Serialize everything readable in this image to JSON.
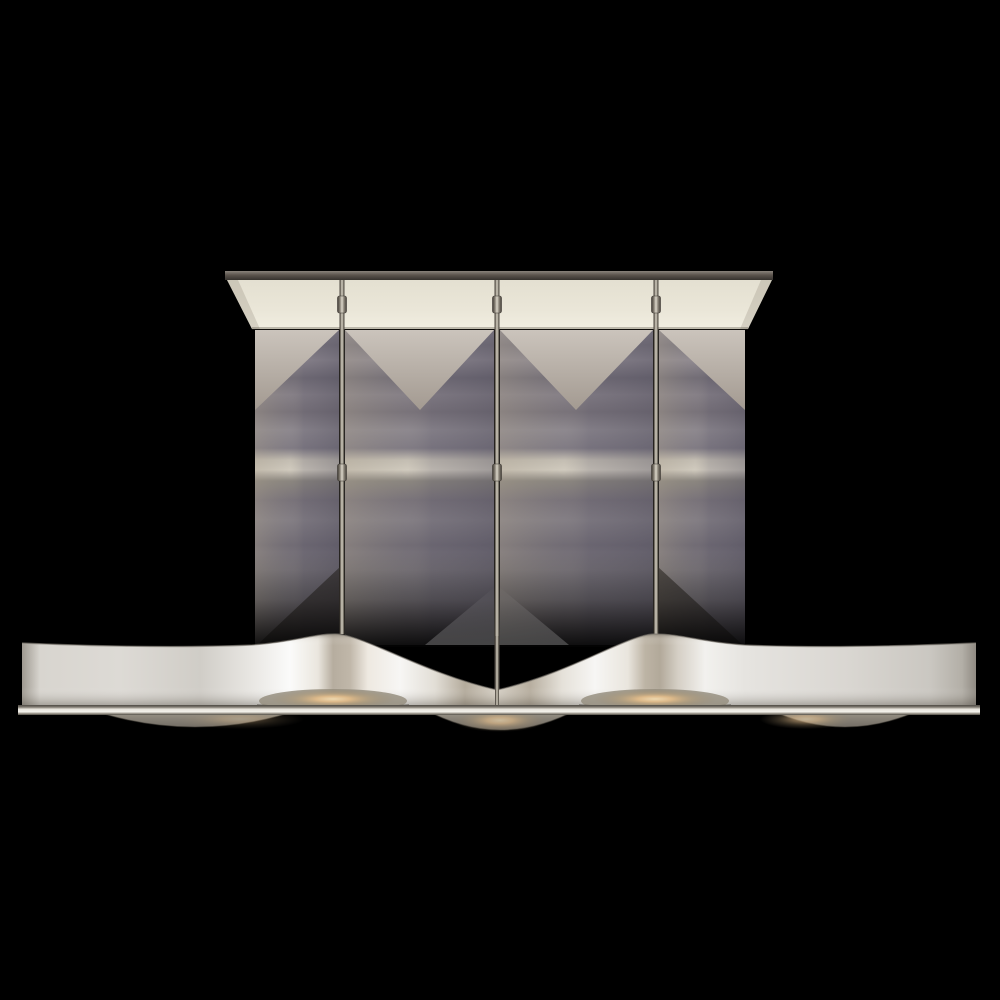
{
  "image": {
    "type": "product-photo",
    "description": "Polished nickel wave linear chandelier with rectangular ceiling canopy, three hanging rods with swivel joints, and a wavy metal band with warm downlights and glass diffuser discs",
    "background": "#000000"
  },
  "palette": {
    "background": "#000000",
    "canopy_face": "#eae6d8",
    "canopy_bar": "#57504a",
    "rod_metal": "#d8d3c6",
    "backdrop_gray": "#7d7883",
    "backdrop_taupe": "#c0b8ae",
    "band_silver": "#e9e7e2",
    "band_tan": "#b2a99a",
    "rail_highlight": "#f0eee8",
    "lamp_glow": "#e0bb8a",
    "glass_gray": "#8a8478"
  },
  "canopy": {
    "bar": {
      "x": 225,
      "y": 271,
      "w": 548,
      "h": 9
    },
    "face": {
      "top_left": 227,
      "top_right": 772,
      "top_y": 280,
      "bottom_left": 252,
      "bottom_right": 748,
      "bottom_y": 329
    }
  },
  "rods": {
    "width": 5,
    "top_y": 280,
    "xs": [
      342,
      497,
      656
    ],
    "bottom_ys": [
      634,
      710,
      634
    ],
    "knuckle_ys": [
      296,
      464
    ],
    "knuckle_h": 17
  },
  "backdrop": {
    "top_y": 330,
    "bottom_y": 645,
    "triangle_depth": 80,
    "fade_start_y": 552,
    "cells": [
      {
        "x1": 255,
        "x2": 339,
        "triangle": "left-outer"
      },
      {
        "x1": 345,
        "x2": 494,
        "triangle": "inner",
        "apex_x": 420
      },
      {
        "x1": 500,
        "x2": 653,
        "triangle": "inner",
        "apex_x": 576
      },
      {
        "x1": 659,
        "x2": 745,
        "triangle": "right-outer"
      }
    ]
  },
  "wave": {
    "left_x": 22,
    "right_x": 976,
    "end_top_y": 643,
    "flat_top_y": 646,
    "crests": [
      {
        "x": 335,
        "top_y": 634
      },
      {
        "x": 655,
        "top_y": 634
      }
    ],
    "dip": {
      "x": 497,
      "top_y": 690
    },
    "band_bottom_y": 710,
    "rail": {
      "x1": 18,
      "x2": 980,
      "y": 705,
      "h": 10
    }
  },
  "lights": {
    "crest_glows": [
      {
        "cx": 333,
        "cy": 699,
        "rx": 62,
        "ry": 10
      },
      {
        "cx": 655,
        "cy": 699,
        "rx": 62,
        "ry": 10
      }
    ],
    "discs": [
      {
        "cx": 195,
        "x1": 88,
        "x2": 302,
        "depth": 18,
        "warm": 0.3,
        "warm_cx": 240
      },
      {
        "cx": 500,
        "x1": 424,
        "x2": 578,
        "depth": 21,
        "warm": 0.65,
        "warm_cx": 500
      },
      {
        "cx": 845,
        "x1": 768,
        "x2": 922,
        "depth": 18,
        "warm": 0.55,
        "warm_cx": 806
      }
    ]
  }
}
